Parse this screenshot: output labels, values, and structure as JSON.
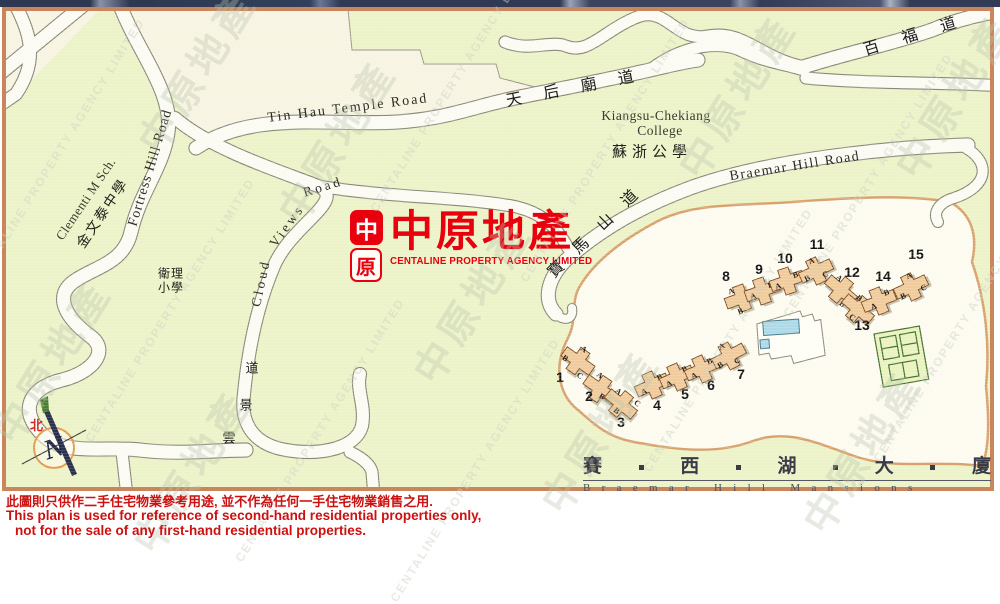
{
  "logo": {
    "seal_top": "中",
    "seal_bottom": "原",
    "name_cn": "中原地產",
    "name_en": "CENTALINE PROPERTY AGENCY LIMITED"
  },
  "compass": {
    "north_label": "北"
  },
  "watermark": {
    "text_cn": "中原地產",
    "text_en": "CENTALINE PROPERTY AGENCY LIMITED",
    "positions": [
      {
        "x": 60,
        "y": 150,
        "t": "en"
      },
      {
        "x": 50,
        "y": 360,
        "t": "cn"
      },
      {
        "x": 195,
        "y": 70,
        "t": "cn"
      },
      {
        "x": 170,
        "y": 310,
        "t": "en"
      },
      {
        "x": 190,
        "y": 470,
        "t": "cn"
      },
      {
        "x": 335,
        "y": 140,
        "t": "cn"
      },
      {
        "x": 320,
        "y": 430,
        "t": "en"
      },
      {
        "x": 455,
        "y": 80,
        "t": "en"
      },
      {
        "x": 470,
        "y": 300,
        "t": "cn"
      },
      {
        "x": 475,
        "y": 470,
        "t": "en"
      },
      {
        "x": 605,
        "y": 150,
        "t": "en"
      },
      {
        "x": 598,
        "y": 430,
        "t": "cn"
      },
      {
        "x": 735,
        "y": 95,
        "t": "cn"
      },
      {
        "x": 728,
        "y": 340,
        "t": "en"
      },
      {
        "x": 868,
        "y": 185,
        "t": "en"
      },
      {
        "x": 860,
        "y": 450,
        "t": "cn"
      },
      {
        "x": 952,
        "y": 95,
        "t": "cn"
      },
      {
        "x": 958,
        "y": 330,
        "t": "en"
      }
    ]
  },
  "map": {
    "labels": [
      {
        "name": "road-label-tin-hau-temple-road-en",
        "text": "Tin Hau Temple Road",
        "x": 348,
        "y": 109,
        "r": -7,
        "s": 14,
        "ls": 2,
        "k": "road"
      },
      {
        "name": "road-label-tin-hau-temple-road-cn",
        "text": "天 后 廟 道",
        "x": 574,
        "y": 86,
        "r": -11,
        "s": 16,
        "ls": 9,
        "k": "roadcn"
      },
      {
        "name": "place-label-kiangsu-chekiang-1",
        "text": "Kiangsu-Chekiang",
        "x": 656,
        "y": 116,
        "r": 0,
        "s": 13.5,
        "ls": 0.5,
        "k": "place"
      },
      {
        "name": "place-label-kiangsu-chekiang-2",
        "text": "College",
        "x": 660,
        "y": 131,
        "r": 0,
        "s": 13.5,
        "ls": 0.5,
        "k": "place"
      },
      {
        "name": "place-label-kiangsu-chekiang-cn",
        "text": "蘇浙公學",
        "x": 652,
        "y": 151,
        "r": 0,
        "s": 15,
        "ls": 5,
        "k": "placecn"
      },
      {
        "name": "road-label-braemar-hill-road-en",
        "text": "Braemar Hill Road",
        "x": 795,
        "y": 167,
        "r": -9,
        "s": 14,
        "ls": 1.5,
        "k": "road"
      },
      {
        "name": "road-label-braemar-hill-road-cn",
        "text": "寶 馬 山 道",
        "x": 594,
        "y": 230,
        "r": -44,
        "s": 16,
        "ls": 7,
        "k": "roadcn"
      },
      {
        "name": "road-label-pak-fuk-road-cn",
        "text": "百 福 道",
        "x": 914,
        "y": 33,
        "r": -17,
        "s": 16,
        "ls": 10,
        "k": "roadcn"
      },
      {
        "name": "road-label-fortress-hill-road",
        "text": "Fortress Hill Road",
        "x": 151,
        "y": 168,
        "r": -73,
        "s": 14,
        "ls": 1,
        "k": "road"
      },
      {
        "name": "place-label-clementi-en",
        "text": "Clementi M Sch.",
        "x": 86,
        "y": 199,
        "r": -56,
        "s": 13,
        "ls": 0.5,
        "k": "place"
      },
      {
        "name": "place-label-clementi-cn",
        "text": "金文泰中學",
        "x": 102,
        "y": 213,
        "r": -56,
        "s": 14,
        "ls": 2,
        "k": "placecn"
      },
      {
        "name": "road-label-cloud-views-road-1",
        "text": "Cloud",
        "x": 261,
        "y": 283,
        "r": -78,
        "s": 13.5,
        "ls": 3,
        "k": "road"
      },
      {
        "name": "road-label-cloud-views-road-2",
        "text": "Views",
        "x": 287,
        "y": 226,
        "r": -54,
        "s": 13.5,
        "ls": 3,
        "k": "road"
      },
      {
        "name": "road-label-cloud-views-road-3",
        "text": "Road",
        "x": 323,
        "y": 187,
        "r": -17,
        "s": 13.5,
        "ls": 3,
        "k": "road"
      },
      {
        "name": "road-label-wan-king-road-1",
        "text": "道",
        "x": 252,
        "y": 367,
        "r": 0,
        "s": 13,
        "ls": 0,
        "k": "roadcn"
      },
      {
        "name": "road-label-wan-king-road-2",
        "text": "景",
        "x": 246,
        "y": 404,
        "r": 0,
        "s": 13,
        "ls": 0,
        "k": "roadcn"
      },
      {
        "name": "road-label-wan-king-road-3",
        "text": "雲",
        "x": 229,
        "y": 437,
        "r": 0,
        "s": 13,
        "ls": 0,
        "k": "roadcn"
      },
      {
        "name": "place-label-methodist-school-1",
        "text": "衛理",
        "x": 171,
        "y": 273,
        "r": 0,
        "s": 12,
        "ls": 1,
        "k": "placecn"
      },
      {
        "name": "place-label-methodist-school-2",
        "text": "小學",
        "x": 171,
        "y": 287,
        "r": 0,
        "s": 12,
        "ls": 1,
        "k": "placecn"
      }
    ]
  },
  "estate": {
    "name_chinese_chars": [
      "賽",
      "西",
      "湖",
      "大",
      "廈"
    ],
    "name_english": "Braemar Hill Mansions",
    "blocks": [
      {
        "n": "1",
        "x": 578,
        "y": 361,
        "r": 35,
        "w": [
          [
            "A",
            -2,
            -13
          ],
          [
            "B",
            -12,
            5
          ],
          [
            "C",
            10,
            11
          ]
        ],
        "nx": 560,
        "ny": 382
      },
      {
        "n": "2",
        "x": 600,
        "y": 389,
        "r": 35,
        "w": [
          [
            "A",
            -8,
            -11
          ],
          [
            "B",
            6,
            5
          ]
        ],
        "nx": 589,
        "ny": 401
      },
      {
        "n": "3",
        "x": 621,
        "y": 404,
        "r": 40,
        "w": [
          [
            "A",
            -10,
            -8
          ],
          [
            "B",
            1,
            8
          ],
          [
            "C",
            12,
            -11
          ]
        ],
        "nx": 621,
        "ny": 427
      },
      {
        "n": "4",
        "x": 652,
        "y": 385,
        "r": -24,
        "w": [
          [
            "A",
            -10,
            3
          ],
          [
            "B",
            10,
            -4
          ]
        ],
        "nx": 657,
        "ny": 410
      },
      {
        "n": "5",
        "x": 677,
        "y": 377,
        "r": -24,
        "w": [
          [
            "A",
            -10,
            3
          ],
          [
            "B",
            10,
            -4
          ]
        ],
        "nx": 685,
        "ny": 399
      },
      {
        "n": "6",
        "x": 702,
        "y": 369,
        "r": -24,
        "w": [
          [
            "A",
            -10,
            3
          ],
          [
            "B",
            10,
            -4
          ]
        ],
        "nx": 711,
        "ny": 390
      },
      {
        "n": "7",
        "x": 729,
        "y": 356,
        "r": -28,
        "w": [
          [
            "A",
            -2,
            -12
          ],
          [
            "B",
            -12,
            4
          ],
          [
            "C",
            5,
            8
          ]
        ],
        "nx": 741,
        "ny": 379
      },
      {
        "n": "8",
        "x": 742,
        "y": 298,
        "r": -20,
        "w": [
          [
            "A",
            -8,
            -10
          ],
          [
            "B",
            -6,
            12
          ],
          [
            "C",
            8,
            -2
          ]
        ],
        "nx": 726,
        "ny": 281
      },
      {
        "n": "9",
        "x": 762,
        "y": 291,
        "r": -19,
        "w": [
          [
            "A",
            -10,
            2
          ],
          [
            "B",
            10,
            -3
          ]
        ],
        "nx": 759,
        "ny": 274
      },
      {
        "n": "10",
        "x": 787,
        "y": 281,
        "r": -19,
        "w": [
          [
            "A",
            -10,
            2
          ],
          [
            "B",
            10,
            -3
          ]
        ],
        "nx": 785,
        "ny": 263
      },
      {
        "n": "11",
        "x": 816,
        "y": 271,
        "r": -25,
        "w": [
          [
            "A",
            0,
            -11
          ],
          [
            "B",
            -11,
            3
          ],
          [
            "C",
            7,
            7
          ]
        ],
        "nx": 817,
        "ny": 249
      },
      {
        "n": "12",
        "x": 841,
        "y": 290,
        "r": 40,
        "w": [
          [
            "A",
            -9,
            -8
          ],
          [
            "B",
            10,
            10
          ]
        ],
        "nx": 852,
        "ny": 277
      },
      {
        "n": "13",
        "x": 858,
        "y": 309,
        "r": 40,
        "w": [
          [
            "B",
            -6,
            -9
          ],
          [
            "C",
            1,
            10
          ]
        ],
        "nx": 862,
        "ny": 330
      },
      {
        "n": "14",
        "x": 879,
        "y": 301,
        "r": -22,
        "w": [
          [
            "A",
            -7,
            3
          ],
          [
            "B",
            10,
            -5
          ]
        ],
        "nx": 883,
        "ny": 281
      },
      {
        "n": "15",
        "x": 911,
        "y": 287,
        "r": -25,
        "w": [
          [
            "A",
            3,
            -11
          ],
          [
            "B",
            -11,
            5
          ],
          [
            "C",
            11,
            6
          ]
        ],
        "nx": 916,
        "ny": 259
      }
    ]
  },
  "disclaimer": {
    "line1": "此圖則只供作二手住宅物業參考用途, 並不作為任何一手住宅物業銷售之用.",
    "line2": "This plan is used for reference of second-hand residential properties only,",
    "line3": "not for the sale of any first-hand residential properties."
  },
  "colors": {
    "accent_red": "#e8000e",
    "map_background": "#edf3c8",
    "road_fill": "#fbfaf3",
    "site_fill": "#fdfbf0",
    "site_border": "#d8a26e",
    "block_fill": "#f0cb9c",
    "frame_border": "#c9855c",
    "pool_blue": "#aedae8",
    "tennis_green": "#e9f2c0",
    "disclaimer_red": "#cc1111",
    "title_ink": "#3b3b47"
  }
}
